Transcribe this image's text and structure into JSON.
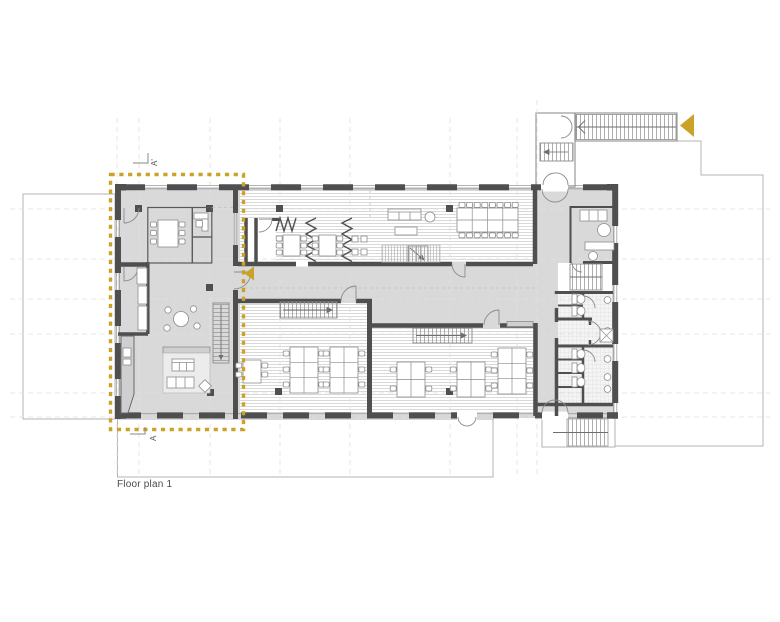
{
  "plan": {
    "caption": "Floor plan 1",
    "markers": {
      "section_top": "A'",
      "section_bottom": "A"
    },
    "selection": {
      "label": "section A-A' highlighted zone",
      "color": "#C9A227"
    },
    "nav_arrows": [
      {
        "name": "corridor-arrow",
        "direction": "left"
      },
      {
        "name": "exterior-stair-arrow",
        "direction": "left"
      }
    ],
    "colors": {
      "accent_gold": "#C9A227",
      "wall_dark": "#4F4F4F",
      "floor_gray": "#D9D9D9",
      "hatch_line": "#C8C8C8",
      "context_outline": "#B3B3B3",
      "gridline": "#E0E0E0",
      "caption_text": "#4A4A4A"
    }
  }
}
